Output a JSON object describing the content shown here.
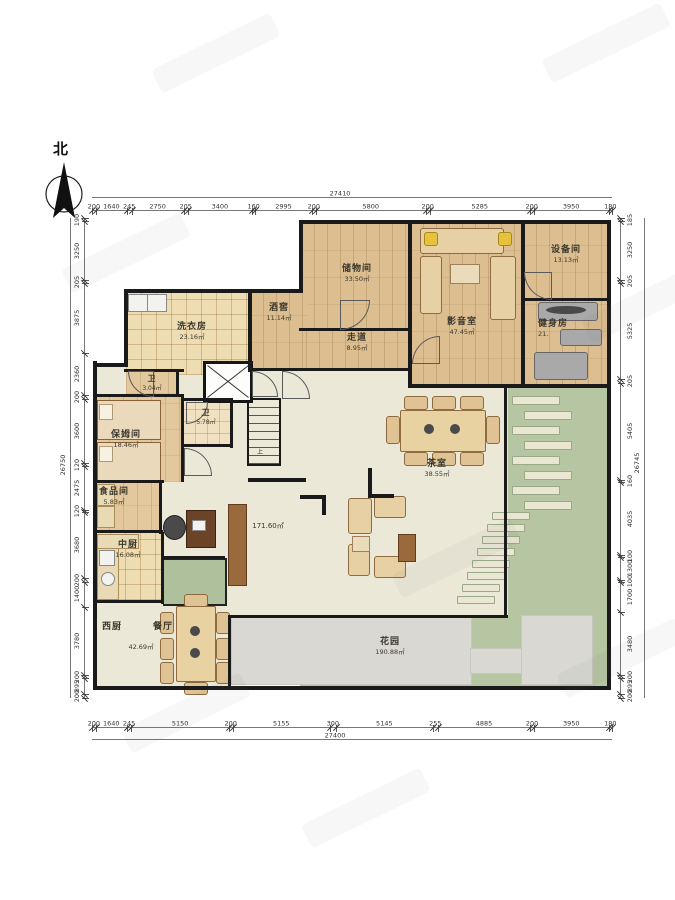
{
  "north": {
    "label": "北"
  },
  "stairs": {
    "up_label": "上"
  },
  "rooms": {
    "chuwujian": {
      "name": "储物间",
      "area": "33.50㎡"
    },
    "jiujiao": {
      "name": "酒窖",
      "area": "11.14㎡"
    },
    "zoudao": {
      "name": "走道",
      "area": "8.95㎡"
    },
    "yingyinshi": {
      "name": "影音室",
      "area": "47.45㎡"
    },
    "shebeijian": {
      "name": "设备间",
      "area": "13.13㎡"
    },
    "jianshenfang": {
      "name": "健身房",
      "area": "21."
    },
    "xiyifang": {
      "name": "洗衣房",
      "area": "23.16㎡"
    },
    "weisheng1": {
      "name": "卫",
      "area": "3.04㎡"
    },
    "weisheng2": {
      "name": "卫",
      "area": "5.78㎡"
    },
    "baomujian": {
      "name": "保姆间",
      "area": "18.46㎡"
    },
    "shipinjian": {
      "name": "食品间",
      "area": "5.83㎡"
    },
    "zhongchu": {
      "name": "中厨",
      "area": "16.08㎡"
    },
    "xichu": {
      "name": "西厨"
    },
    "canting": {
      "name": "餐厅",
      "area": "42.69㎡"
    },
    "chashi": {
      "name": "茶室",
      "area": "38.55㎡"
    },
    "keting": {
      "area": "171.60㎡"
    },
    "huayuan": {
      "name": "花园",
      "area": "190.88㎡"
    }
  },
  "dimensions": {
    "top": {
      "total": "27410",
      "segments": [
        200,
        1640,
        245,
        2750,
        205,
        3400,
        160,
        2995,
        200,
        5800,
        200,
        5285,
        200,
        3950,
        180
      ]
    },
    "bottom": {
      "total": "27400",
      "segments": [
        200,
        1640,
        245,
        5150,
        200,
        5155,
        300,
        5145,
        255,
        4885,
        200,
        3950,
        180
      ]
    },
    "left": {
      "total": "26750",
      "segments": [
        190,
        3250,
        205,
        3875,
        2360,
        200,
        3600,
        120,
        2475,
        120,
        3680,
        200,
        1400,
        3780,
        200,
        895,
        200
      ]
    },
    "right": {
      "total": "26745",
      "segments": [
        185,
        3250,
        205,
        5325,
        205,
        5405,
        160,
        4035,
        100,
        1300,
        100,
        1700,
        3480,
        200,
        895,
        200
      ]
    }
  },
  "colors": {
    "wood_floor": "#dcbe90",
    "indoor_cream": "#ebe8d8",
    "garden_green": "#b6c5a2",
    "terrace_grey": "#d9d8d2",
    "wall_black": "#1a1a1a"
  }
}
